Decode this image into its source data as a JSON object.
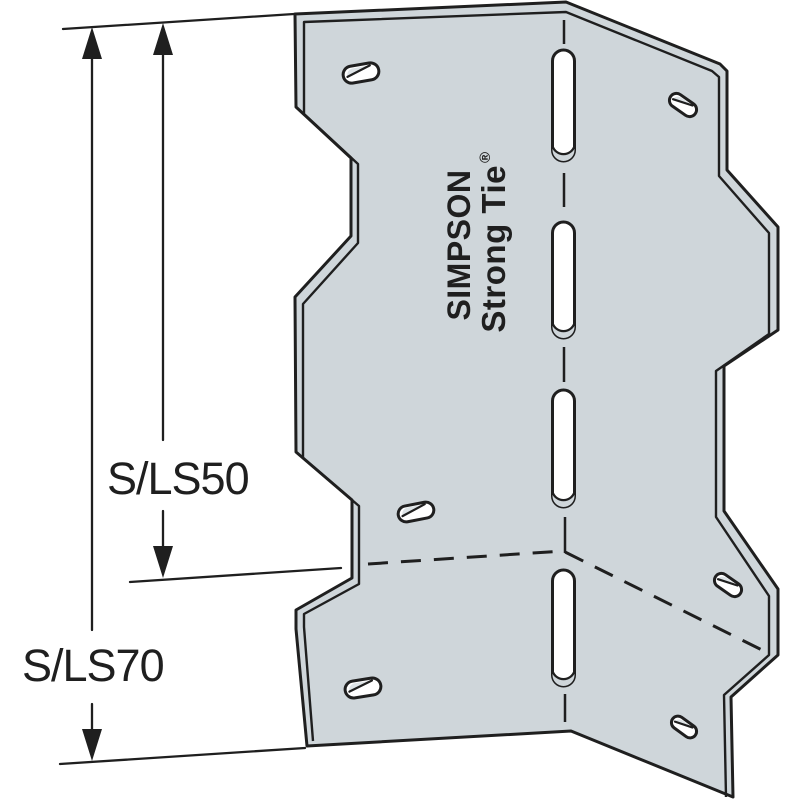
{
  "illustration": {
    "brand": {
      "line1": "SIMPSON",
      "line2": "Strong Tie",
      "registered": "®"
    },
    "size_labels": {
      "sls50": "S/LS50",
      "sls70": "S/LS70"
    }
  },
  "colors": {
    "background": "#ffffff",
    "plate_fill": "#cfd6da",
    "line": "#1f1f1f",
    "slot_fill": "#ffffff",
    "countersink_shade": "#dee4e7"
  }
}
